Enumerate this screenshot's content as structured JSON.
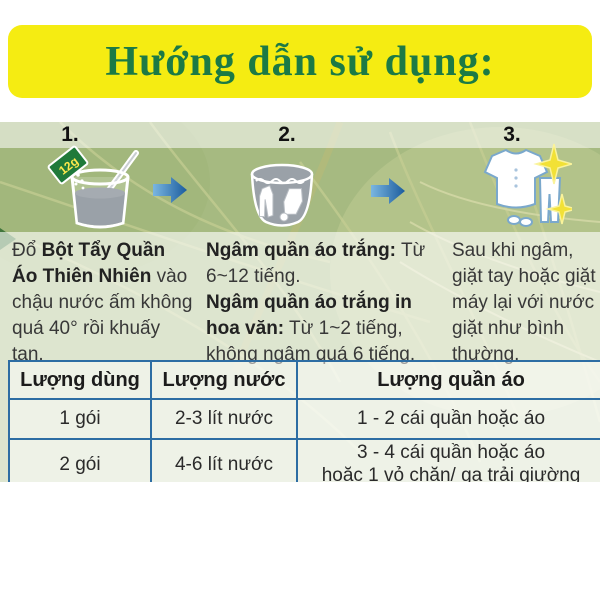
{
  "title": "Hướng dẫn sử dụng:",
  "steps": [
    {
      "number": "1.",
      "packet_label": "12g",
      "pre": "Đổ ",
      "bold": "Bột Tẩy Quần Áo Thiên Nhiên",
      "post": " vào chậu nước ấm không quá 40° rồi khuấy tan."
    },
    {
      "number": "2.",
      "bold1": "Ngâm quần áo trắng:",
      "text1": " Từ 6~12 tiếng.",
      "bold2": "Ngâm quần áo trắng in hoa văn:",
      "text2": " Từ 1~2 tiếng, không ngâm quá 6 tiếng."
    },
    {
      "number": "3.",
      "text": "Sau khi ngâm, giặt tay hoặc giặt máy lại với nước giặt như bình thường."
    }
  ],
  "table": {
    "headers": [
      "Lượng dùng",
      "Lượng nước",
      "Lượng quần áo"
    ],
    "rows": [
      [
        "1 gói",
        "2-3 lít nước",
        "1 - 2 cái quần hoặc áo"
      ],
      [
        "2 gói",
        "4-6 lít nước",
        "3 - 4 cái quần hoặc áo\nhoặc 1 vỏ chăn/ ga trải giường"
      ]
    ]
  },
  "colors": {
    "banner_yellow": "#f5ec12",
    "title_green": "#1c7a45",
    "table_border_blue": "#2d6da3",
    "arrow_blue_light": "#7ab6e0",
    "arrow_blue_dark": "#1b5c9e",
    "sparkle_yellow": "#f2e136",
    "water_gray": "#9aa1a8",
    "packet_green": "#1f7a3a",
    "leaf_green": "#a6ba81"
  }
}
